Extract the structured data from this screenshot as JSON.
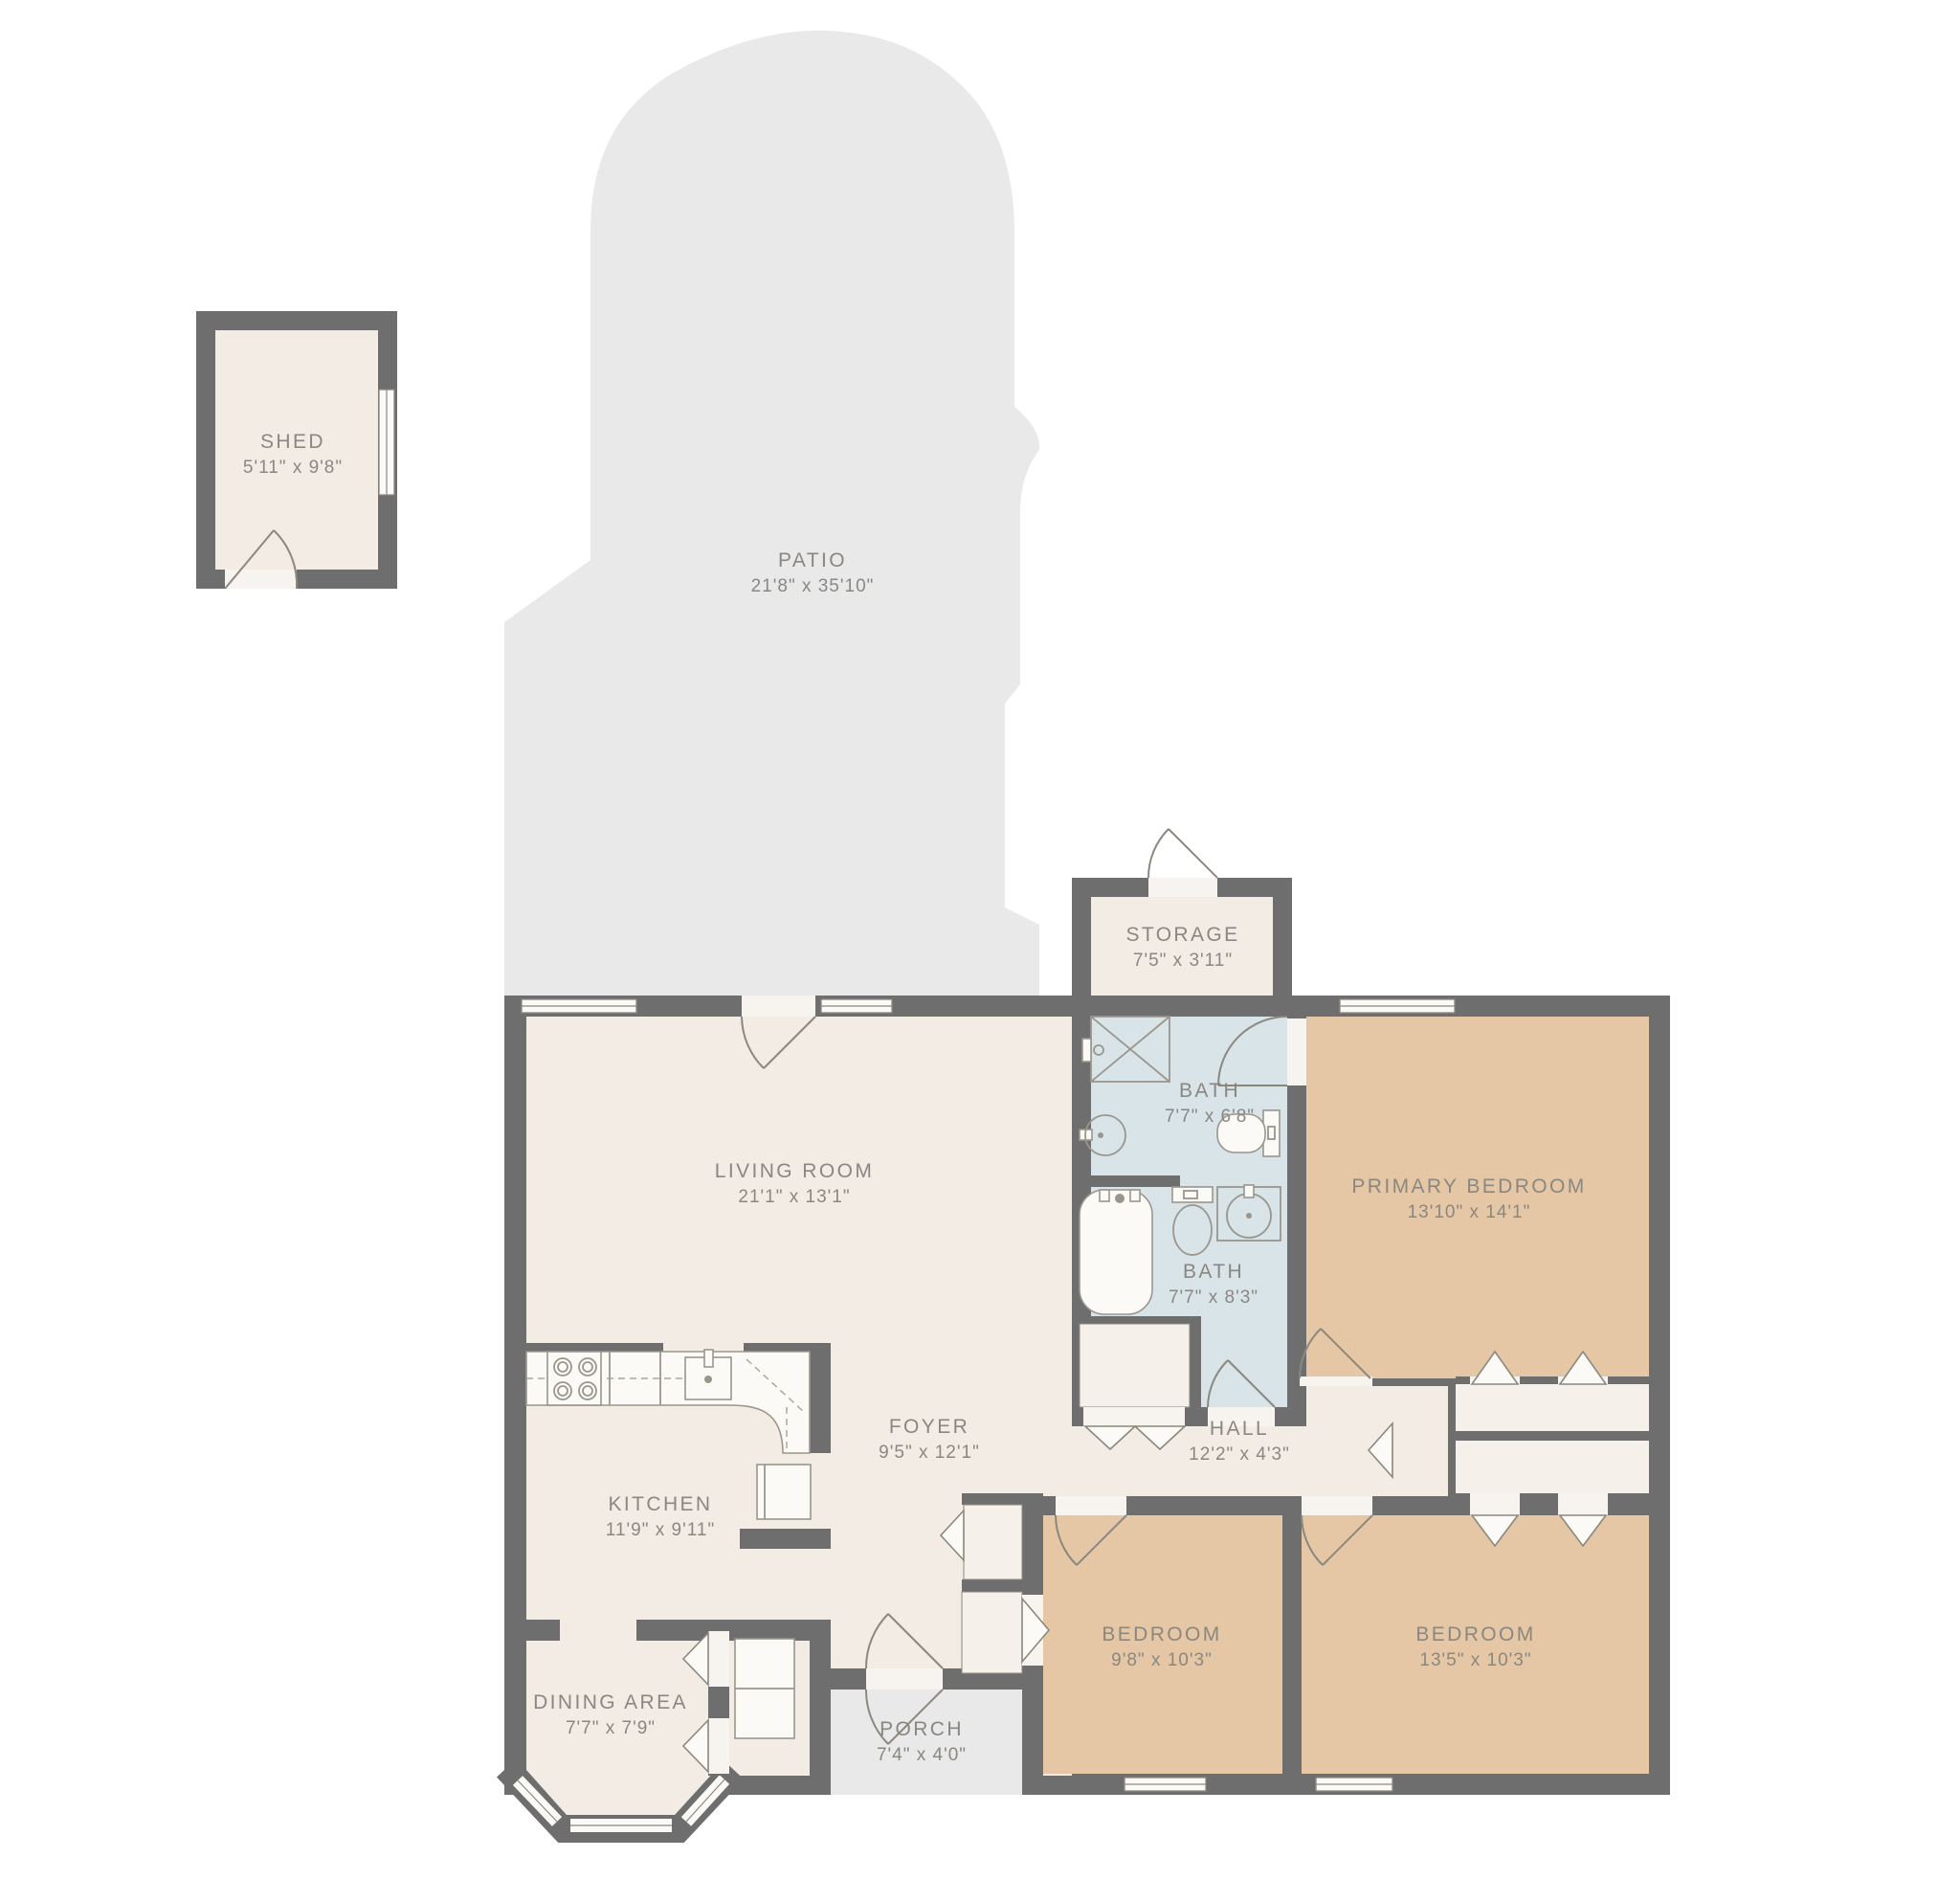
{
  "rooms": {
    "shed": {
      "name": "SHED",
      "dims": "5'11\" x 9'8\""
    },
    "patio": {
      "name": "PATIO",
      "dims": "21'8\" x 35'10\""
    },
    "storage": {
      "name": "STORAGE",
      "dims": "7'5\" x 3'11\""
    },
    "living_room": {
      "name": "LIVING ROOM",
      "dims": "21'1\" x 13'1\""
    },
    "bath1": {
      "name": "BATH",
      "dims": "7'7\" x 6'8\""
    },
    "primary_bedroom": {
      "name": "PRIMARY BEDROOM",
      "dims": "13'10\" x 14'1\""
    },
    "bath2": {
      "name": "BATH",
      "dims": "7'7\" x 8'3\""
    },
    "foyer": {
      "name": "FOYER",
      "dims": "9'5\" x 12'1\""
    },
    "hall": {
      "name": "HALL",
      "dims": "12'2\" x 4'3\""
    },
    "kitchen": {
      "name": "KITCHEN",
      "dims": "11'9\" x 9'11\""
    },
    "dining_area": {
      "name": "DINING AREA",
      "dims": "7'7\" x 7'9\""
    },
    "bedroom1": {
      "name": "BEDROOM",
      "dims": "9'8\" x 10'3\""
    },
    "bedroom2": {
      "name": "BEDROOM",
      "dims": "13'5\" x 10'3\""
    },
    "porch": {
      "name": "PORCH",
      "dims": "7'4\" x 4'0\""
    }
  },
  "colors": {
    "wall": "#6e6e6e",
    "interior_floor": "#f2ece5",
    "bedroom_floor": "#e5c7a5",
    "bath_floor": "#d9e4e9",
    "outdoor": "#e9e9e9",
    "closet": "#f5f0ea",
    "label_text": "#8a8781"
  }
}
